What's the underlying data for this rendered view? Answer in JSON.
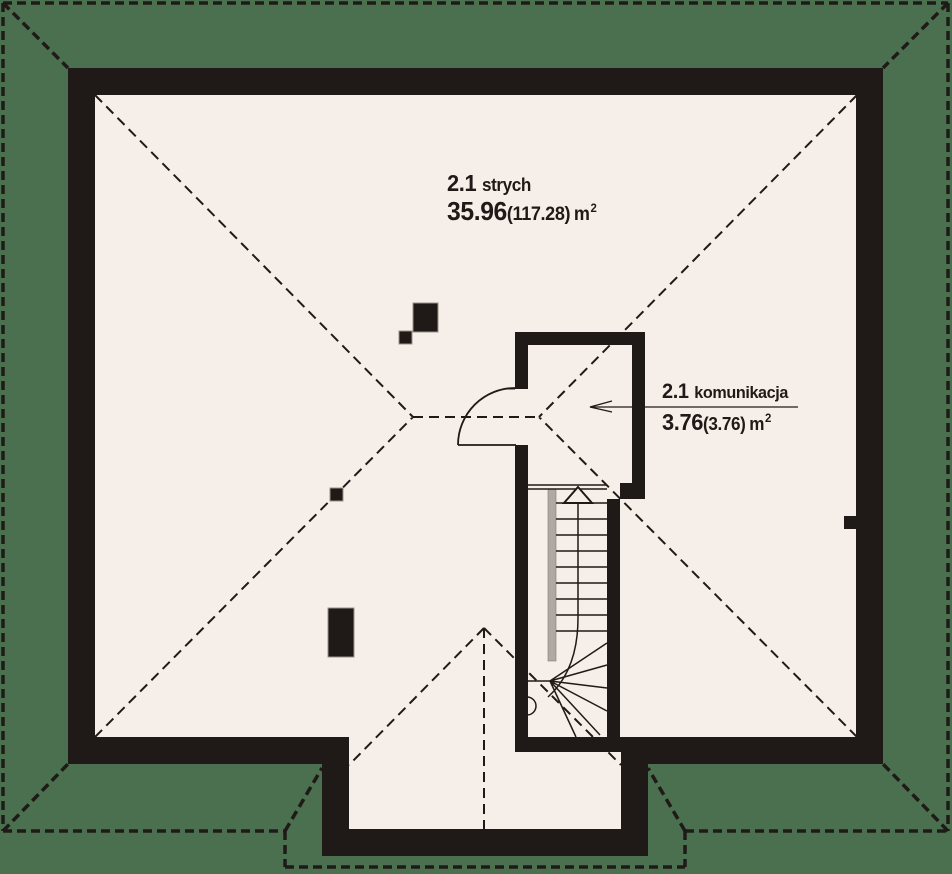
{
  "plan": {
    "type": "architectural-floor-plan",
    "rooms": [
      {
        "number": "2.1",
        "name": "strych",
        "area": "35.96",
        "area_paren": "(117.28)",
        "unit_base": "m",
        "unit_sup": "2"
      },
      {
        "number": "2.1",
        "name": "komunikacja",
        "area": "3.76",
        "area_paren": "(3.76)",
        "unit_base": "m",
        "unit_sup": "2"
      }
    ],
    "features": [
      "hipped-roof-dashed-outline",
      "roof-eaves-dashed-border",
      "staircase-with-winders",
      "door-swing-arc",
      "chimney-blocks",
      "front-porch-projection"
    ]
  },
  "colors": {
    "background": "#4A7050",
    "floor": "#F6EFE9",
    "walls": "#1F1A17",
    "stair_gray": "#B0A9A2",
    "chimney_outline": "#9A938C"
  }
}
